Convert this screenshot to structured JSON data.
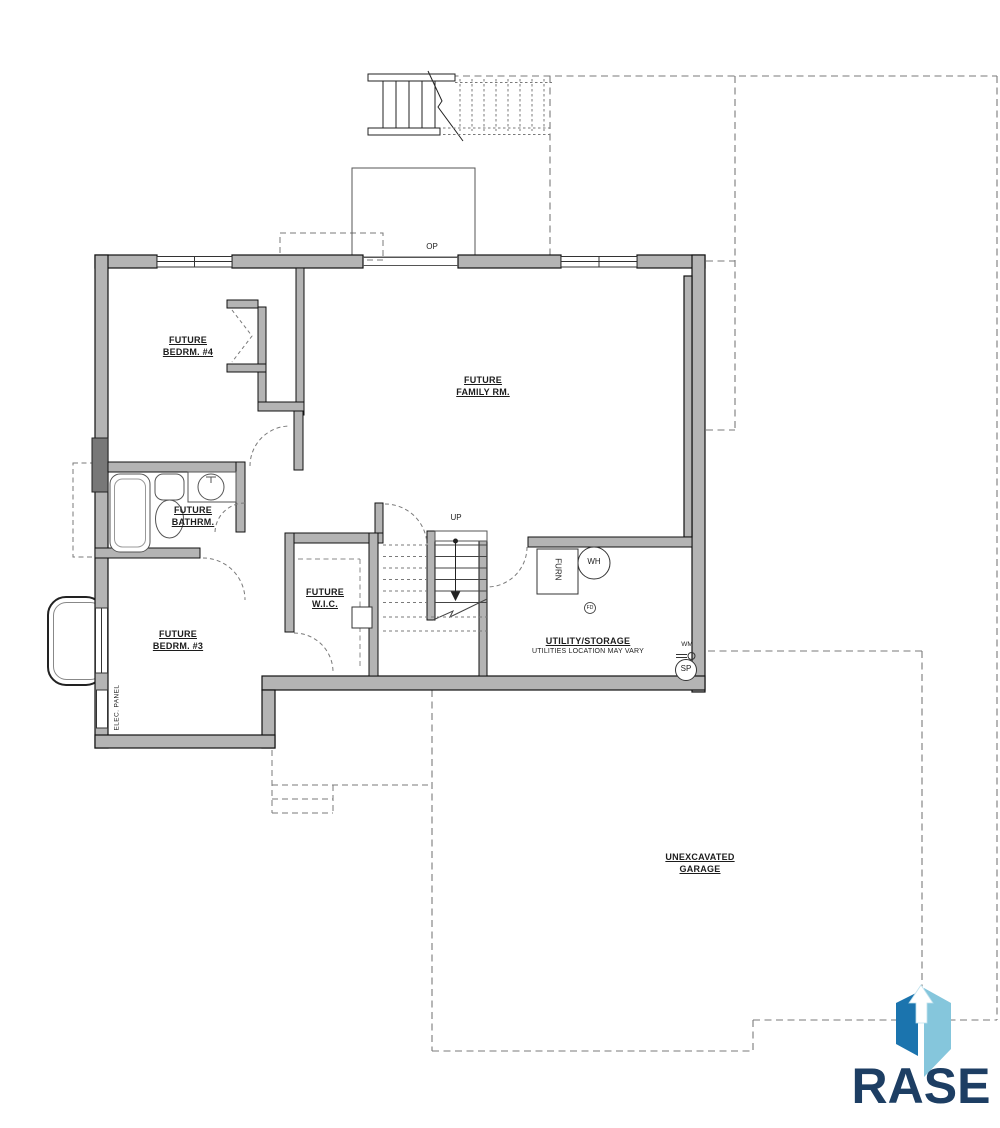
{
  "rooms": [
    {
      "id": "bedroom4",
      "lines": [
        "FUTURE",
        "BEDRM. #4"
      ]
    },
    {
      "id": "family-room",
      "lines": [
        "FUTURE",
        "FAMILY RM."
      ]
    },
    {
      "id": "bathroom",
      "lines": [
        "FUTURE",
        "BATHRM."
      ]
    },
    {
      "id": "bedroom3",
      "lines": [
        "FUTURE",
        "BEDRM. #3"
      ]
    },
    {
      "id": "walk-in-closet",
      "lines": [
        "FUTURE",
        "W.I.C."
      ]
    },
    {
      "id": "utility-storage",
      "lines": [
        "UTILITY/STORAGE"
      ],
      "note": "UTILITIES LOCATION MAY VARY"
    },
    {
      "id": "garage",
      "lines": [
        "UNEXCAVATED",
        "GARAGE"
      ]
    }
  ],
  "annotations": {
    "opening": "OP",
    "stairs_up": "UP",
    "furnace": "FURN",
    "water_heater": "WH",
    "floor_drain": "FD",
    "water_meter": "WM",
    "sump_pit": "SP",
    "electrical_panel": "ELEC. PANEL"
  },
  "logo": {
    "wordmark": "RASE"
  },
  "colors": {
    "background": "#ffffff",
    "wall_fill": "#b4b4b4",
    "wall_line": "#111111",
    "thin_line": "#555555",
    "dashed_line": "#7a7a7a",
    "logo_navy": "#1d3e63",
    "logo_blue": "#1b74ae",
    "logo_light_blue": "#85c6dc"
  }
}
